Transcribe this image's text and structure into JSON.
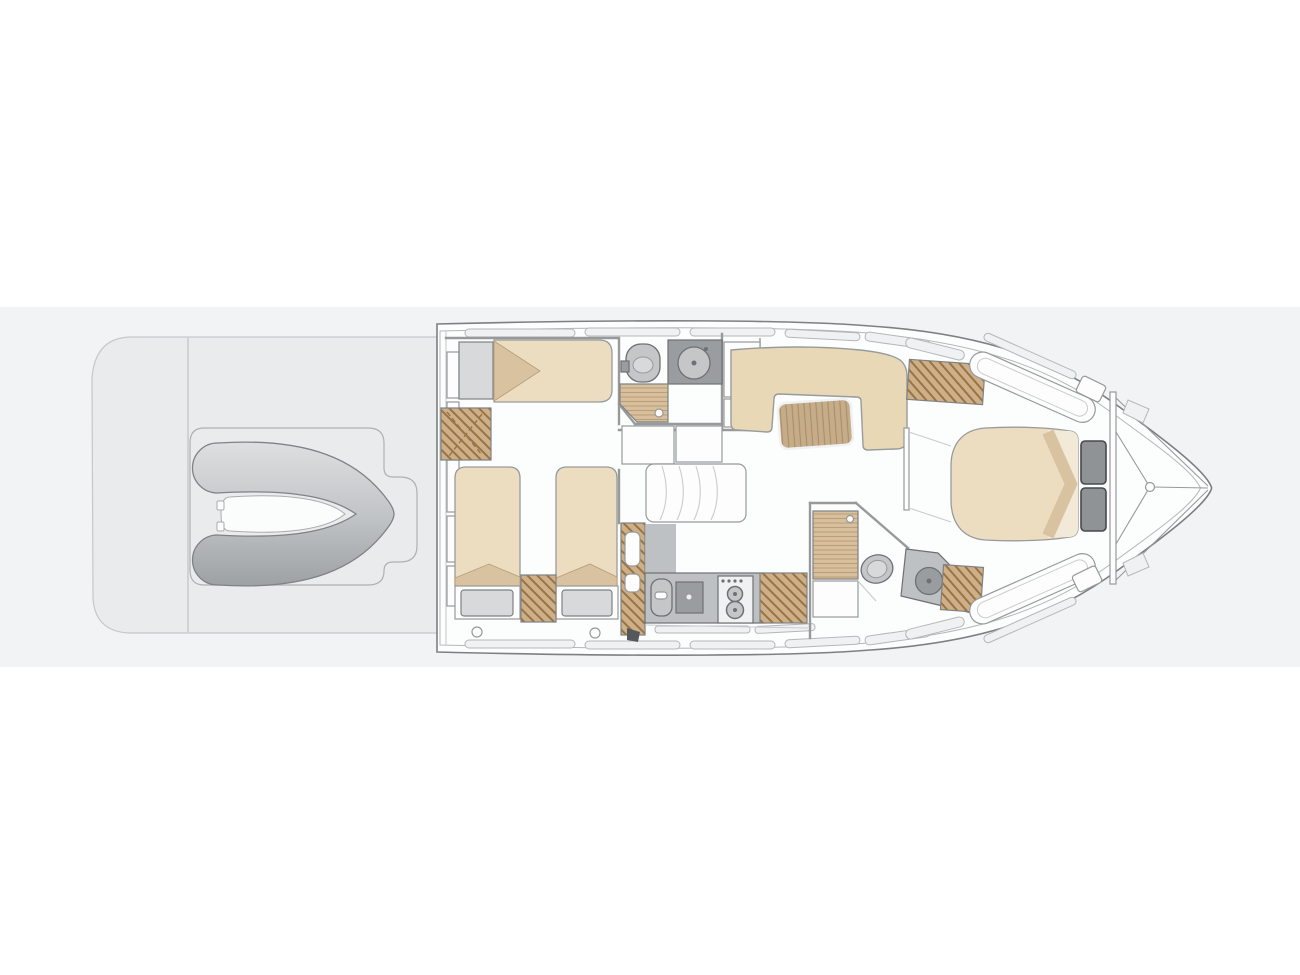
{
  "figure": {
    "type": "yacht-deck-floor-plan",
    "areas": [
      "swim-platform",
      "tender-garage",
      "tender",
      "aft-berth-cabin",
      "guest-cabin-twin-beds",
      "aft-bathroom",
      "staircase",
      "galley",
      "dinette-salon",
      "day-head-bathroom",
      "master-cabin",
      "bow"
    ]
  },
  "colors": {
    "background": "#ffffff",
    "band": "#f2f3f4",
    "outline": "#7d8082",
    "innerLine": "#b4b7b9",
    "deck": "#fcfdfd",
    "wall": "#97999b",
    "lightLine": "#c9cccd",
    "strip": "#f0f1f2",
    "platform": "#e9ebec",
    "platformEdge": "#c5c8ca",
    "recessEdge": "#aeb1b3",
    "tubeLight": "#dddfe0",
    "tubeMid": "#c2c5c7",
    "tubeDark": "#9da1a3",
    "tenderEdge": "#7f8385",
    "tenderFloor": "#fbfcfc",
    "tenderFloorEdge": "#aaadaf",
    "mattress": "#ecdcc0",
    "mattressEdge": "#989b9d",
    "sheet": "#d8c2a0",
    "sheetEdge": "#b49c78",
    "sheetLight": "#f2e9d8",
    "pillow": "#d7d9da",
    "pillowEdge": "#7e8183",
    "headboard": "#909395",
    "headboardEdge": "#47494b",
    "sofa": "#e9d8b6",
    "woodBase": "#c6ad89",
    "woodGrain": "#a68a64",
    "hatchBase": "#cdb08a",
    "hatchLine": "#9a7342",
    "hatchEdge": "#7f8284",
    "showerBase": "#d8bf9e",
    "showerLine": "#bb9f78",
    "counter": "#bec1c3",
    "counterDark": "#9a9da0",
    "fixture": "#c4c6c8",
    "fixtureEdge": "#6e7173",
    "white": "#fdfdfd",
    "dark": "#55585a"
  }
}
